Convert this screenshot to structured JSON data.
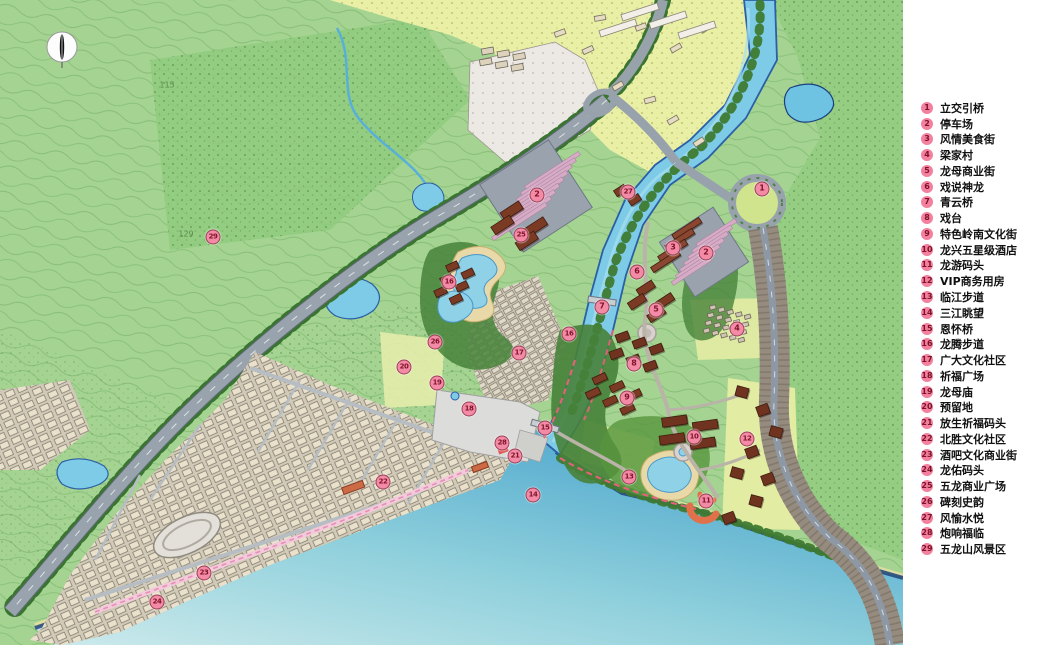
{
  "map": {
    "compass": {
      "x": 62,
      "y": 47
    },
    "annotations": [
      {
        "text": "129",
        "x": 186,
        "y": 234
      },
      {
        "text": "115",
        "x": 167,
        "y": 85
      }
    ],
    "markers": [
      {
        "num": "1",
        "x": 762,
        "y": 189
      },
      {
        "num": "2",
        "x": 537,
        "y": 195
      },
      {
        "num": "2",
        "x": 706,
        "y": 253
      },
      {
        "num": "3",
        "x": 673,
        "y": 248
      },
      {
        "num": "4",
        "x": 737,
        "y": 329
      },
      {
        "num": "5",
        "x": 656,
        "y": 310
      },
      {
        "num": "6",
        "x": 637,
        "y": 272
      },
      {
        "num": "7",
        "x": 602,
        "y": 307
      },
      {
        "num": "8",
        "x": 634,
        "y": 364
      },
      {
        "num": "9",
        "x": 627,
        "y": 398
      },
      {
        "num": "10",
        "x": 694,
        "y": 437
      },
      {
        "num": "11",
        "x": 706,
        "y": 501
      },
      {
        "num": "12",
        "x": 747,
        "y": 439
      },
      {
        "num": "13",
        "x": 629,
        "y": 477
      },
      {
        "num": "14",
        "x": 533,
        "y": 495
      },
      {
        "num": "15",
        "x": 545,
        "y": 428
      },
      {
        "num": "16",
        "x": 449,
        "y": 282
      },
      {
        "num": "16",
        "x": 569,
        "y": 334
      },
      {
        "num": "17",
        "x": 519,
        "y": 353
      },
      {
        "num": "18",
        "x": 469,
        "y": 409
      },
      {
        "num": "19",
        "x": 437,
        "y": 383
      },
      {
        "num": "20",
        "x": 404,
        "y": 367
      },
      {
        "num": "21",
        "x": 515,
        "y": 456
      },
      {
        "num": "22",
        "x": 383,
        "y": 482
      },
      {
        "num": "23",
        "x": 204,
        "y": 573
      },
      {
        "num": "24",
        "x": 157,
        "y": 602
      },
      {
        "num": "25",
        "x": 521,
        "y": 235
      },
      {
        "num": "26",
        "x": 435,
        "y": 342
      },
      {
        "num": "27",
        "x": 628,
        "y": 192
      },
      {
        "num": "28",
        "x": 502,
        "y": 443
      },
      {
        "num": "29",
        "x": 213,
        "y": 237
      }
    ],
    "colors": {
      "hill_green": "#a5d492",
      "forest_green": "#8fca7d",
      "field_yellow": "#e9efa5",
      "river_blue": "#7ecbe7",
      "sea_deep": "#44a0cb",
      "marker_pink": "#f38ba6",
      "building_brown": "#7b3a24"
    }
  },
  "legend": {
    "items": [
      {
        "num": "1",
        "label": "立交引桥"
      },
      {
        "num": "2",
        "label": "停车场"
      },
      {
        "num": "3",
        "label": "风情美食街"
      },
      {
        "num": "4",
        "label": "梁家村"
      },
      {
        "num": "5",
        "label": "龙母商业街"
      },
      {
        "num": "6",
        "label": "戏说神龙"
      },
      {
        "num": "7",
        "label": "青云桥"
      },
      {
        "num": "8",
        "label": "戏台"
      },
      {
        "num": "9",
        "label": "特色岭南文化街"
      },
      {
        "num": "10",
        "label": "龙兴五星级酒店"
      },
      {
        "num": "11",
        "label": "龙游码头"
      },
      {
        "num": "12",
        "label": "VIP商务用房"
      },
      {
        "num": "13",
        "label": "临江步道"
      },
      {
        "num": "14",
        "label": "三江眺望"
      },
      {
        "num": "15",
        "label": "恩怀桥"
      },
      {
        "num": "16",
        "label": "龙腾步道"
      },
      {
        "num": "17",
        "label": "广大文化社区"
      },
      {
        "num": "18",
        "label": "祈福广场"
      },
      {
        "num": "19",
        "label": "龙母庙"
      },
      {
        "num": "20",
        "label": "预留地"
      },
      {
        "num": "21",
        "label": "放生祈福码头"
      },
      {
        "num": "22",
        "label": "北胜文化社区"
      },
      {
        "num": "23",
        "label": "酒吧文化商业街"
      },
      {
        "num": "24",
        "label": "龙佑码头"
      },
      {
        "num": "25",
        "label": "五龙商业广场"
      },
      {
        "num": "26",
        "label": "碑刻史韵"
      },
      {
        "num": "27",
        "label": "风愉水悦"
      },
      {
        "num": "28",
        "label": "炮响福临"
      },
      {
        "num": "29",
        "label": "五龙山风景区"
      }
    ]
  }
}
